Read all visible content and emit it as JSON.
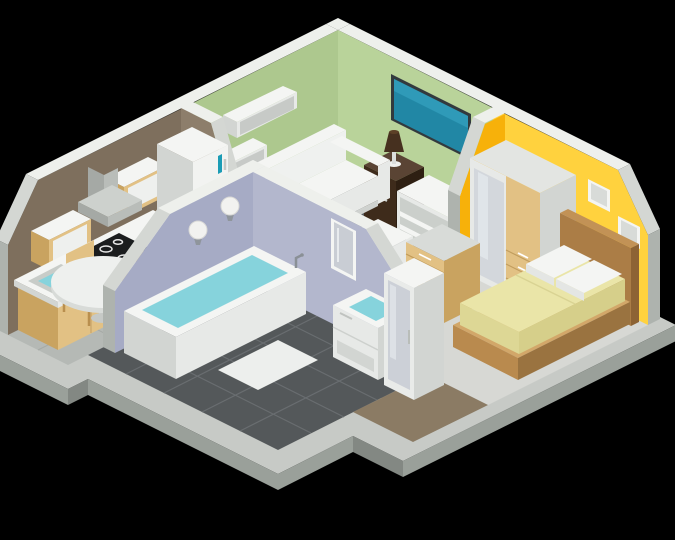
{
  "scene": {
    "type": "isometric-apartment-cutaway",
    "background": "black"
  },
  "colors": {
    "background": "#000000",
    "slab_top": "#c7cac6",
    "slab_side": "#9aa09a",
    "wall_rim": "#eef0ec",
    "wall_cut": "#d4d7d3",
    "wall_end": "#aeb3ae",
    "wall_green_left": "#adc88e",
    "wall_green_right": "#b9d39a",
    "wall_brown": "#7e6f5d",
    "wall_brown_partition": "#8d7e6b",
    "wall_yellow": "#ffd23e",
    "wall_orange_partition": "#f7b10a",
    "wall_lavender": "#a6abc5",
    "wall_lavender_light": "#b3b7cd",
    "living_floor": "#5d6163",
    "kitchen_floor": "#b5b9b5",
    "bathroom_floor": "#54585a",
    "bedroom_floor": "#d7d8d4",
    "hall_floor": "#8b7b64",
    "white_top": "#f4f5f3",
    "white_front": "#e7e9e7",
    "white_side": "#d2d5d2",
    "tan_front": "#e2c184",
    "tan_side": "#c9a360",
    "tan_light": "#ecd5a4",
    "dark_wood": "#3e2b1b",
    "dark_wood_side": "#2e1f12",
    "dark_wood_top": "#5a4434",
    "bed_frame": "#b98a4e",
    "bed_frame_dark": "#9a7340",
    "headboard": "#ab7d46",
    "bedding": "#eae5a8",
    "bedding_side": "#ddd795",
    "water": "#86d3dc",
    "tv_screen": "#2187a5",
    "accent_teal": "#1b9cb5",
    "tile_line": "#696d70"
  },
  "rooms": [
    {
      "id": "living-room",
      "label": "living room",
      "furniture": [
        "sofa",
        "ottoman",
        "wall-mounted-tv",
        "tv-stand",
        "nightstand",
        "table-lamp",
        "wall-shelf",
        "wall-shelf"
      ]
    },
    {
      "id": "kitchen",
      "label": "kitchen",
      "furniture": [
        "refrigerator",
        "wall-cabinet",
        "wall-cabinet",
        "cooker-hood",
        "cooktop",
        "oven",
        "sink",
        "base-cabinets",
        "round-dining-table",
        "chair",
        "chair",
        "chair"
      ]
    },
    {
      "id": "bedroom",
      "label": "bedroom",
      "furniture": [
        "double-bed",
        "pillows",
        "wardrobe",
        "chest-of-drawers",
        "picture-frame",
        "picture-frame"
      ]
    },
    {
      "id": "bathroom",
      "label": "bathroom",
      "furniture": [
        "bathtub",
        "vanity-sink",
        "wall-mirror",
        "tall-mirror-cabinet",
        "wall-lamp",
        "wall-lamp",
        "bath-mat"
      ]
    }
  ]
}
